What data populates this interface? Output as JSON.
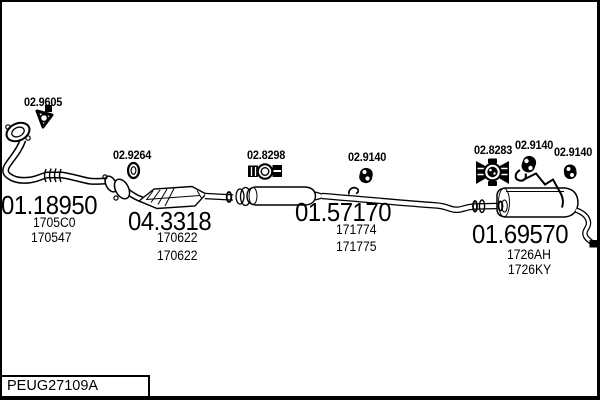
{
  "figure": {
    "code": "PEUG27109A"
  },
  "colors": {
    "line": "#000000",
    "background": "#ffffff"
  },
  "parts": [
    {
      "number": "02.9605",
      "refs": []
    },
    {
      "number": "01.18950",
      "refs": [
        "1705C0",
        "170547"
      ]
    },
    {
      "number": "02.9264",
      "refs": []
    },
    {
      "number": "04.3318",
      "refs": [
        "170622",
        "170622"
      ]
    },
    {
      "number": "02.8298",
      "refs": []
    },
    {
      "number": "02.9140",
      "refs": []
    },
    {
      "number": "01.57170",
      "refs": [
        "171774",
        "171775"
      ]
    },
    {
      "number": "02.8283",
      "refs": []
    },
    {
      "number": "02.9140",
      "refs": []
    },
    {
      "number": "02.9140",
      "refs": []
    },
    {
      "number": "01.69570",
      "refs": [
        "1726AH",
        "1726KY"
      ]
    }
  ]
}
